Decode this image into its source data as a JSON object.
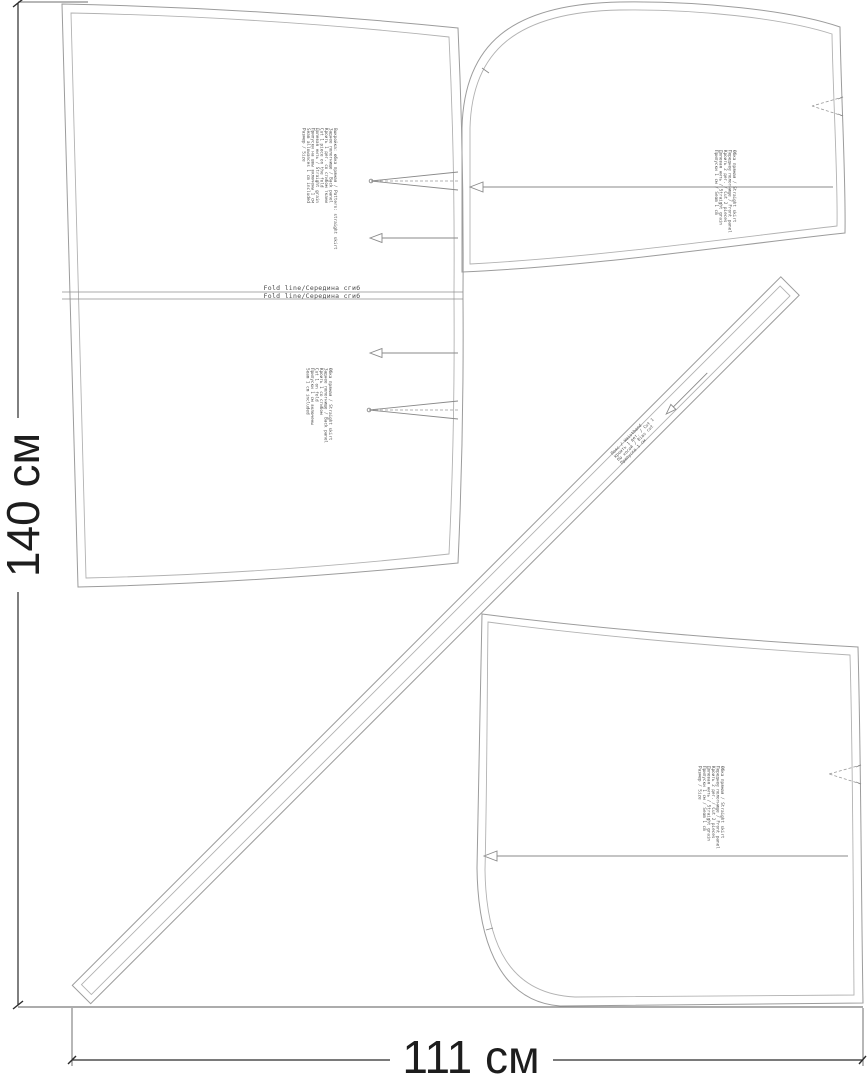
{
  "dimensions": {
    "height": "140 см",
    "width": "111 см"
  },
  "fold": {
    "top": "Fold line/Середина сгиб",
    "bottom": "Fold line/Середина сгиб"
  },
  "pieces": {
    "back": {
      "labels": [
        "Выкройка: юбка прямая / Pattern: straight skirt",
        "Заднее полотнище / Back panel",
        "Кроить 1 дет. со сгибом ткани",
        "Cut 1 piece on the fold",
        "Долевая нить / Straight grain",
        "Припуски на швы включены 1 см",
        "Seam allowances 1 cm included",
        "Размер / Size"
      ],
      "labels_mirror": [
        "Юбка прямая / Straight skirt",
        "Заднее полотнище / Back panel",
        "Кроить 1 со сгибом",
        "Cut 1 on fold",
        "Припуски 1 см включены",
        "Seam 1 cm included"
      ]
    },
    "front_upper": {
      "labels": [
        "Юбка прямая / Straight skirt",
        "Переднее полотнище / Front panel",
        "Кроить 2 дет. / Cut 2 pieces",
        "Долевая нить / Straight grain",
        "Припуски 1 см / Seam 1 cm"
      ]
    },
    "front_lower": {
      "labels": [
        "Юбка прямая / Straight skirt",
        "Переднее полотнище / Front panel",
        "Кроить 2 дет. / Cut 2 pieces",
        "Долевая нить / Straight grain",
        "Припуски 1 см / Seam 1 cm",
        "Размер / Size"
      ]
    },
    "waistband": {
      "labels": [
        "Пояс / Waistband",
        "Кроить 1 дет. / Cut 1",
        "По косой / Bias cut",
        "Припуски 1 см"
      ]
    }
  },
  "colors": {
    "cut_line": "#9c9c9c",
    "seam_line": "#b2b2b2",
    "dimension": "#2b2b2b",
    "tiny_text": "#555555",
    "fabric_edge": "#7a7a7a"
  }
}
